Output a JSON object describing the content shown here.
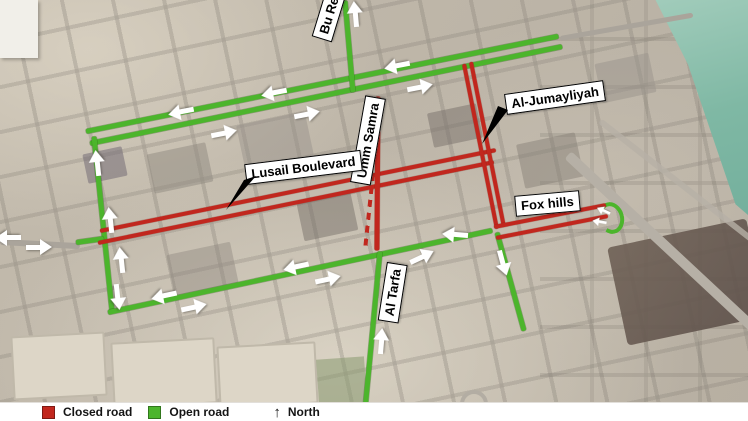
{
  "legend": {
    "closed": {
      "label": "Closed road",
      "color": "#C1271E"
    },
    "open": {
      "label": "Open road",
      "color": "#4CB52C"
    },
    "north": {
      "label": "North",
      "glyph": "↑"
    }
  },
  "colors": {
    "closed_road": "#C1271E",
    "open_road": "#4CB52C",
    "arrow": "#FFFFFF"
  },
  "roads": [
    {
      "name": "Lusail Boulevard",
      "status": "Closed road"
    },
    {
      "name": "Al-Jumayliyah",
      "status": "Closed road"
    },
    {
      "name": "Fox hills",
      "status": "Closed road"
    },
    {
      "name": "Umm Samra",
      "status": "Closed road"
    },
    {
      "name": "Al Tarfa",
      "status": "Open road"
    },
    {
      "name": "Bu Redda",
      "status": "Open road"
    }
  ]
}
